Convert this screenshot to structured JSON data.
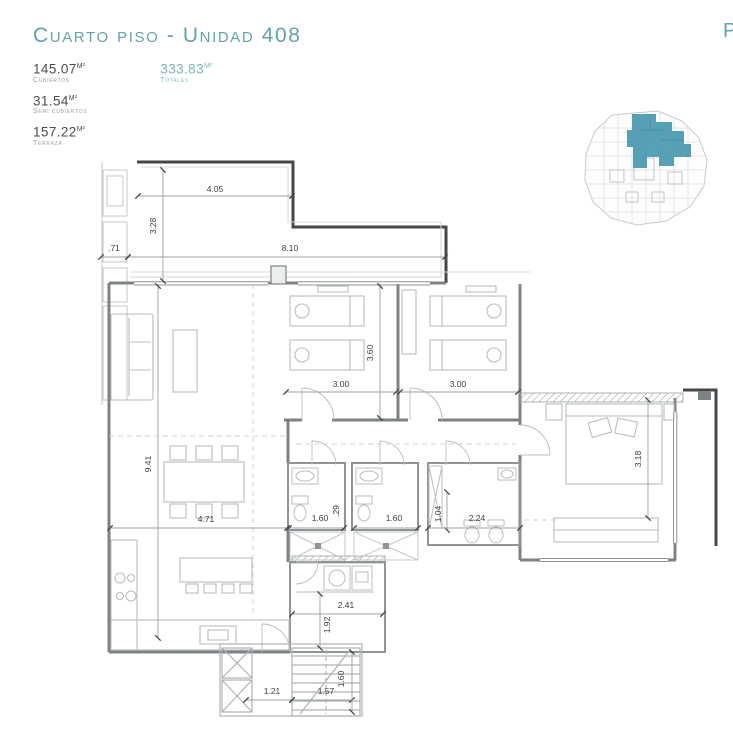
{
  "header": {
    "title": "Cuarto piso - Unidad 408",
    "corner_letter": "P"
  },
  "stats": [
    {
      "value": "145.07",
      "unit": "M²",
      "label": "Cubiertos"
    },
    {
      "value": "31.54",
      "unit": "M²",
      "label": "Semi cubiertos"
    },
    {
      "value": "157.22",
      "unit": "M²",
      "label": "Terraza"
    },
    {
      "value": "333.83",
      "unit": "M²",
      "label": "Totales"
    }
  ],
  "colors": {
    "accent_teal": "#62a3b0",
    "keyplan_highlight": "#4e9cb3",
    "parapet_dark": "#43474a",
    "wall_gray": "#7d8284",
    "detail_light": "#b9bdbf"
  },
  "plan": {
    "dims": {
      "terrace_top": "4.05",
      "terrace_side": "3.28",
      "side_strip": ".71",
      "facade": "8.10",
      "bedroom1_width": "3.00",
      "bedroom_depth": "3.60",
      "bedroom2_width": "3.00",
      "living_depth": "9.41",
      "living_width": "4.71",
      "bath1_width": "1.60",
      "wall_gap": ".29",
      "bath2_width": "1.60",
      "bath_depth": "1.04",
      "master_bath_width": "2.24",
      "master_depth": "3.18",
      "laundry_width": "2.41",
      "laundry_depth": "1.92",
      "landing_width": "1.21",
      "stair_width": "1.57",
      "stair_depth": "1.60"
    }
  }
}
